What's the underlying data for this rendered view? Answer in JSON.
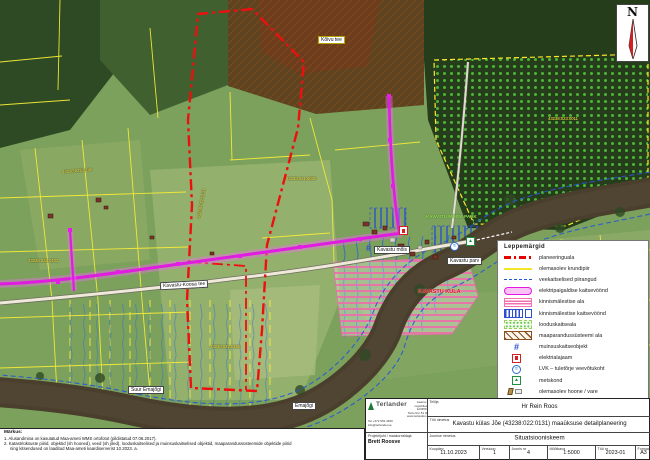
{
  "north": {
    "label": "N"
  },
  "legend": {
    "title": "Leppemärgid",
    "items": [
      {
        "label": "planeeringuala"
      },
      {
        "label": "olemasolev krundipiir"
      },
      {
        "label": "veekaitselised piirangud"
      },
      {
        "label": "elektripaigaldise kaitsevöönd"
      },
      {
        "label": "kinnismälestise ala"
      },
      {
        "label": "kinnismälestise kaitsevöönd"
      },
      {
        "label": "looduskaitseala"
      },
      {
        "label": "maaparandussüsteemi ala"
      },
      {
        "label": "muinsuskaitseobjekt"
      },
      {
        "label": "elektrialajaam"
      },
      {
        "label": "LVK – tuletõrje veevõtukoht"
      },
      {
        "label": "metskond"
      },
      {
        "label": "olemasolev hoone / vare"
      }
    ]
  },
  "map": {
    "labels": {
      "road": "Kavastu-Koosa tee",
      "manor": "Kavastu mõis",
      "ferry": "Kavastu parv",
      "river_main": "Suur Emajõgi",
      "river_small": "Emajõgi",
      "village": "KAVASTU KÜLA",
      "park": "KAVASTU MÕISA PARK",
      "road_small": "Kõivu tee"
    },
    "parcels": [
      "43238:022:0131",
      "43238:022:0140",
      "43238:021:0030",
      "43238:022:0102",
      "43238:023:0011",
      "43238:022:0160"
    ]
  },
  "notes": {
    "heading": "Märkus:",
    "lines": [
      "1. Alusandmina on kasutatud Maa-ameti WMS ortofotot (pildistatud 07.06.2017).",
      "2. Katastriüksuste piirid, objektid (sh hooned), veed (sh jõed), looduskaitselised ja muinsuskaitselised objektid, maaparandussüsteemide objektide piirid",
      "ning kitsendused on laaditud Maa-ameti kaardiserverist 10.2023. a."
    ]
  },
  "titleblock": {
    "company": {
      "name": "Terlander",
      "address_lines": [
        "Jaama 60",
        "registrikood 12345678",
        "Tartu linn 51 009",
        "www.terlander.ee"
      ],
      "contact_lines": [
        "Tel +372 502 4456",
        "info@terlander.ee"
      ],
      "role_label": "Projektijuht / maakorraldaja",
      "person": "Brett Roosve"
    },
    "client_label": "Tellija",
    "client": "Hr Rein Roos",
    "project_label": "Töö nimetus",
    "project": "Kavastu külas Jõe (43238:022:0131) maaüksuse detailplaneering",
    "drawing_label": "Joonise nimetus",
    "drawing": "Situatsiooniskeem",
    "fields": [
      {
        "label": "Kuupäev",
        "value": "11.10.2023"
      },
      {
        "label": "Versioon",
        "value": "1"
      },
      {
        "label": "Joonis nr",
        "value": "4"
      },
      {
        "label": "Mõõtkava",
        "value": "1:5000"
      },
      {
        "label": "Töö nr",
        "value": "2023-01"
      },
      {
        "label": "Formaat",
        "value": "A3"
      }
    ]
  }
}
